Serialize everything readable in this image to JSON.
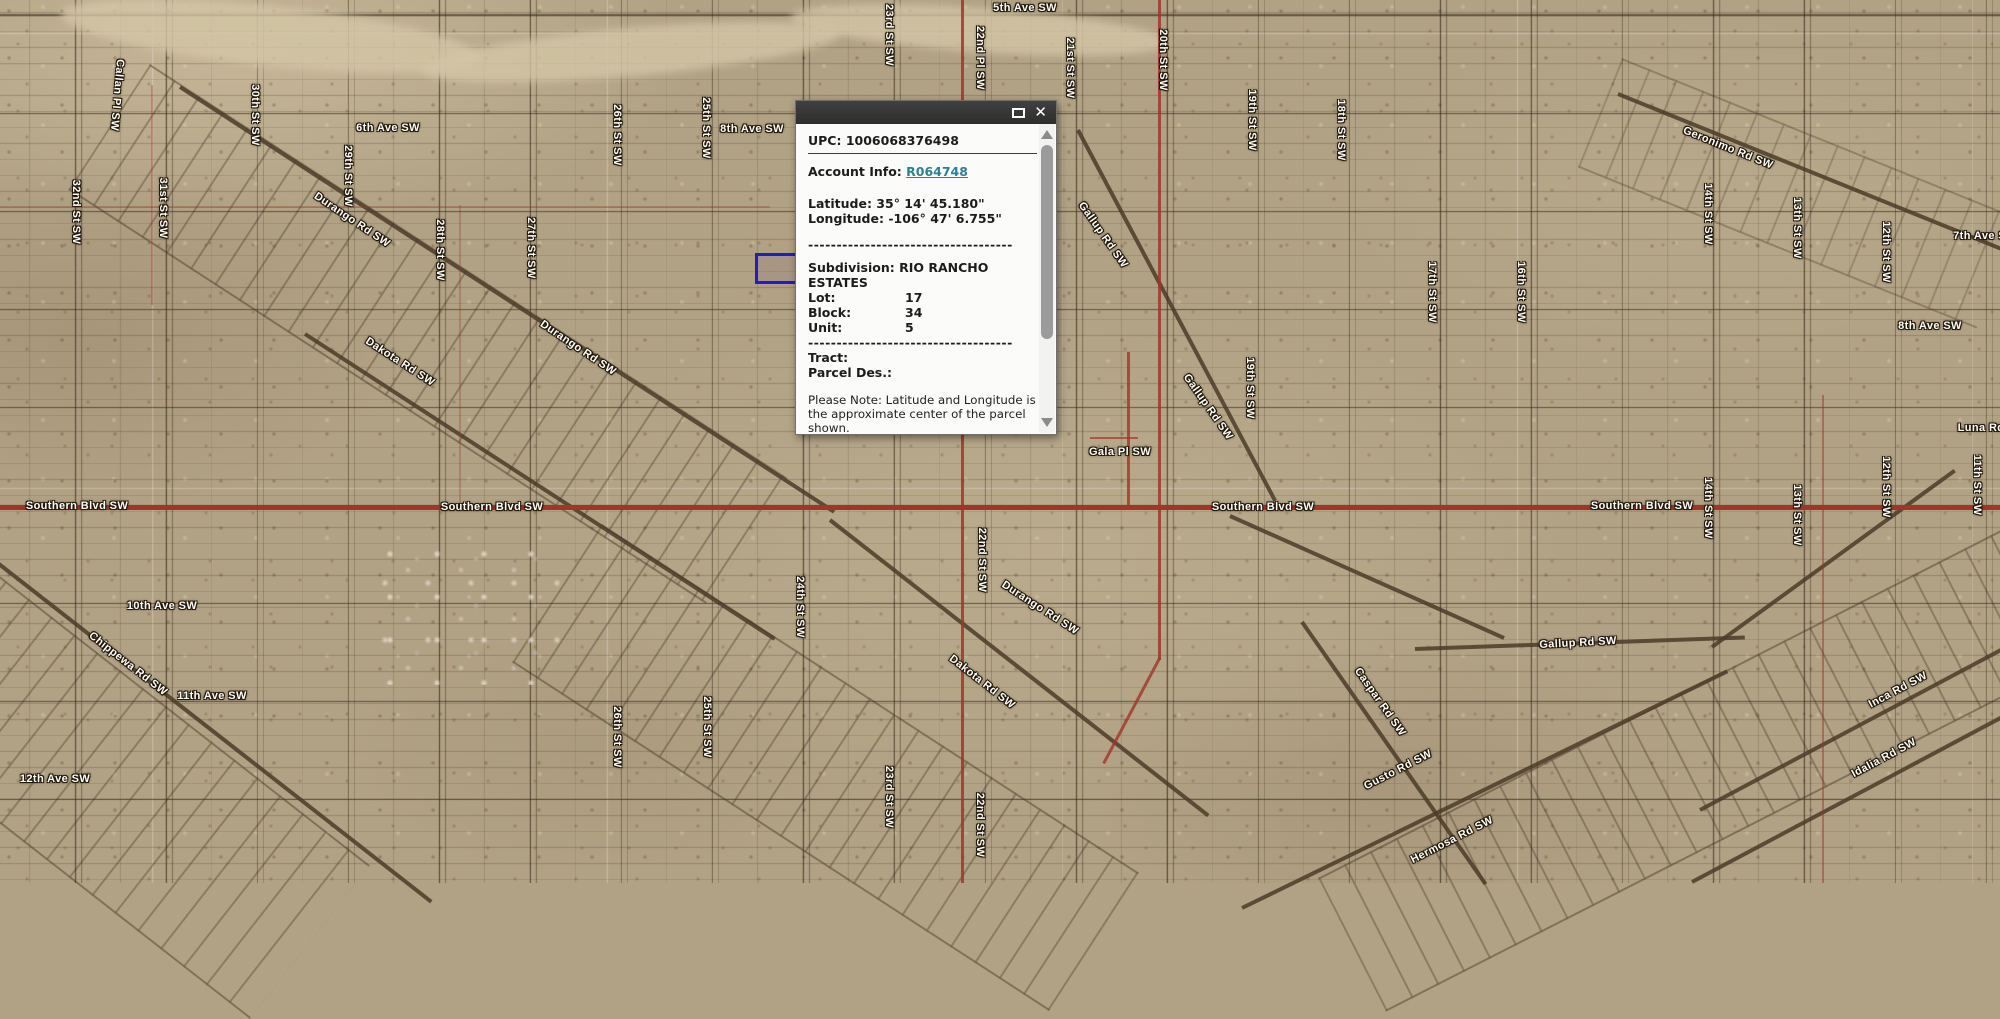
{
  "colors": {
    "selection-blue": "#1d1dcb",
    "road-red": "#a33429",
    "link-teal": "#2e7f95",
    "header-dark": "#404040"
  },
  "popup": {
    "close_glyph": "✕",
    "upc": "UPC: 1006068376498",
    "account_label": "Account Info: ",
    "account_link": "R064748",
    "latitude": "Latitude: 35° 14' 45.180\"",
    "longitude": "Longitude: -106° 47' 6.755\"",
    "divider": "------------------------------------",
    "subdivision": "Subdivision: RIO RANCHO ESTATES",
    "fields": [
      {
        "label": "Lot:",
        "value": "17"
      },
      {
        "label": "Block:",
        "value": "34"
      },
      {
        "label": "Unit:",
        "value": "5"
      }
    ],
    "tract_label": "Tract:",
    "parcel_des_label": "Parcel Des.:",
    "note": "Please Note: Latitude and Longitude is the approximate center of the parcel shown."
  },
  "map": {
    "labels": [
      {
        "text": "5th Ave SW",
        "x": 1025,
        "y": 8,
        "rot": 0
      },
      {
        "text": "6th Ave SW",
        "x": 388,
        "y": 128,
        "rot": 0
      },
      {
        "text": "8th Ave SW",
        "x": 752,
        "y": 129,
        "rot": 0
      },
      {
        "text": "7th Ave SW",
        "x": 1985,
        "y": 236,
        "rot": 0
      },
      {
        "text": "8th Ave SW",
        "x": 1930,
        "y": 326,
        "rot": 0
      },
      {
        "text": "Luna Rd SW",
        "x": 1992,
        "y": 428,
        "rot": 0
      },
      {
        "text": "Gala Pl SW",
        "x": 1120,
        "y": 452,
        "rot": 0
      },
      {
        "text": "Southern Blvd SW",
        "x": 77,
        "y": 506,
        "rot": 0
      },
      {
        "text": "Southern Blvd SW",
        "x": 492,
        "y": 507,
        "rot": 0
      },
      {
        "text": "Southern Blvd SW",
        "x": 1263,
        "y": 507,
        "rot": 0
      },
      {
        "text": "Southern Blvd SW",
        "x": 1642,
        "y": 506,
        "rot": 0
      },
      {
        "text": "10th Ave SW",
        "x": 162,
        "y": 606,
        "rot": 0
      },
      {
        "text": "11th Ave SW",
        "x": 212,
        "y": 696,
        "rot": 0
      },
      {
        "text": "12th Ave SW",
        "x": 55,
        "y": 779,
        "rot": 0
      },
      {
        "text": "Gallup Rd SW",
        "x": 1578,
        "y": 643,
        "rot": -3
      },
      {
        "text": "Callan Pl SW",
        "x": 117,
        "y": 95,
        "rot": 95
      },
      {
        "text": "32nd St SW",
        "x": 76,
        "y": 212,
        "rot": 90
      },
      {
        "text": "31st St SW",
        "x": 163,
        "y": 208,
        "rot": 90
      },
      {
        "text": "30th St SW",
        "x": 255,
        "y": 115,
        "rot": 90
      },
      {
        "text": "29th St SW",
        "x": 348,
        "y": 176,
        "rot": 90
      },
      {
        "text": "28th St SW",
        "x": 440,
        "y": 250,
        "rot": 90
      },
      {
        "text": "27th St SW",
        "x": 531,
        "y": 248,
        "rot": 90
      },
      {
        "text": "26th St SW",
        "x": 617,
        "y": 135,
        "rot": 90
      },
      {
        "text": "25th St SW",
        "x": 706,
        "y": 128,
        "rot": 90
      },
      {
        "text": "26th St SW",
        "x": 617,
        "y": 737,
        "rot": 90
      },
      {
        "text": "25th St SW",
        "x": 707,
        "y": 727,
        "rot": 90
      },
      {
        "text": "24th St SW",
        "x": 800,
        "y": 607,
        "rot": 90
      },
      {
        "text": "23rd St SW",
        "x": 889,
        "y": 797,
        "rot": 90
      },
      {
        "text": "23rd St SW",
        "x": 889,
        "y": 35,
        "rot": 90
      },
      {
        "text": "22nd Pl SW",
        "x": 980,
        "y": 58,
        "rot": 90
      },
      {
        "text": "21st St SW",
        "x": 1070,
        "y": 68,
        "rot": 90
      },
      {
        "text": "22nd St SW",
        "x": 980,
        "y": 825,
        "rot": 90
      },
      {
        "text": "22nd St SW",
        "x": 982,
        "y": 560,
        "rot": 90
      },
      {
        "text": "20th St SW",
        "x": 1163,
        "y": 60,
        "rot": 90
      },
      {
        "text": "19th St SW",
        "x": 1252,
        "y": 120,
        "rot": 90
      },
      {
        "text": "18th St SW",
        "x": 1341,
        "y": 130,
        "rot": 90
      },
      {
        "text": "19th St SW",
        "x": 1250,
        "y": 388,
        "rot": 90
      },
      {
        "text": "17th St SW",
        "x": 1432,
        "y": 292,
        "rot": 90
      },
      {
        "text": "16th St SW",
        "x": 1521,
        "y": 292,
        "rot": 90
      },
      {
        "text": "14th St SW",
        "x": 1708,
        "y": 214,
        "rot": 90
      },
      {
        "text": "13th St SW",
        "x": 1797,
        "y": 228,
        "rot": 90
      },
      {
        "text": "12th St SW",
        "x": 1886,
        "y": 252,
        "rot": 90
      },
      {
        "text": "14th St SW",
        "x": 1708,
        "y": 508,
        "rot": 90
      },
      {
        "text": "13th St SW",
        "x": 1797,
        "y": 515,
        "rot": 90
      },
      {
        "text": "12th St SW",
        "x": 1886,
        "y": 487,
        "rot": 90
      },
      {
        "text": "11th St SW",
        "x": 1977,
        "y": 485,
        "rot": 90
      },
      {
        "text": "Durango Rd SW",
        "x": 352,
        "y": 220,
        "rot": 34
      },
      {
        "text": "Durango Rd SW",
        "x": 578,
        "y": 348,
        "rot": 34
      },
      {
        "text": "Durango Rd SW",
        "x": 1040,
        "y": 608,
        "rot": 33
      },
      {
        "text": "Dakota Rd SW",
        "x": 400,
        "y": 362,
        "rot": 33
      },
      {
        "text": "Dakota Rd SW",
        "x": 982,
        "y": 682,
        "rot": 38
      },
      {
        "text": "Chippewa Rd SW",
        "x": 128,
        "y": 664,
        "rot": 38
      },
      {
        "text": "Geronimo Rd SW",
        "x": 1728,
        "y": 148,
        "rot": 22
      },
      {
        "text": "Gallup Rd SW",
        "x": 1103,
        "y": 235,
        "rot": 55
      },
      {
        "text": "Gallup Rd SW",
        "x": 1208,
        "y": 407,
        "rot": 55
      },
      {
        "text": "Caspar Rd SW",
        "x": 1380,
        "y": 702,
        "rot": 55
      },
      {
        "text": "Gusto Rd SW",
        "x": 1398,
        "y": 770,
        "rot": -27
      },
      {
        "text": "Hermosa Rd SW",
        "x": 1452,
        "y": 840,
        "rot": -27
      },
      {
        "text": "Inca Rd SW",
        "x": 1898,
        "y": 690,
        "rot": -28
      },
      {
        "text": "Idalia Rd SW",
        "x": 1884,
        "y": 758,
        "rot": -28
      }
    ]
  }
}
